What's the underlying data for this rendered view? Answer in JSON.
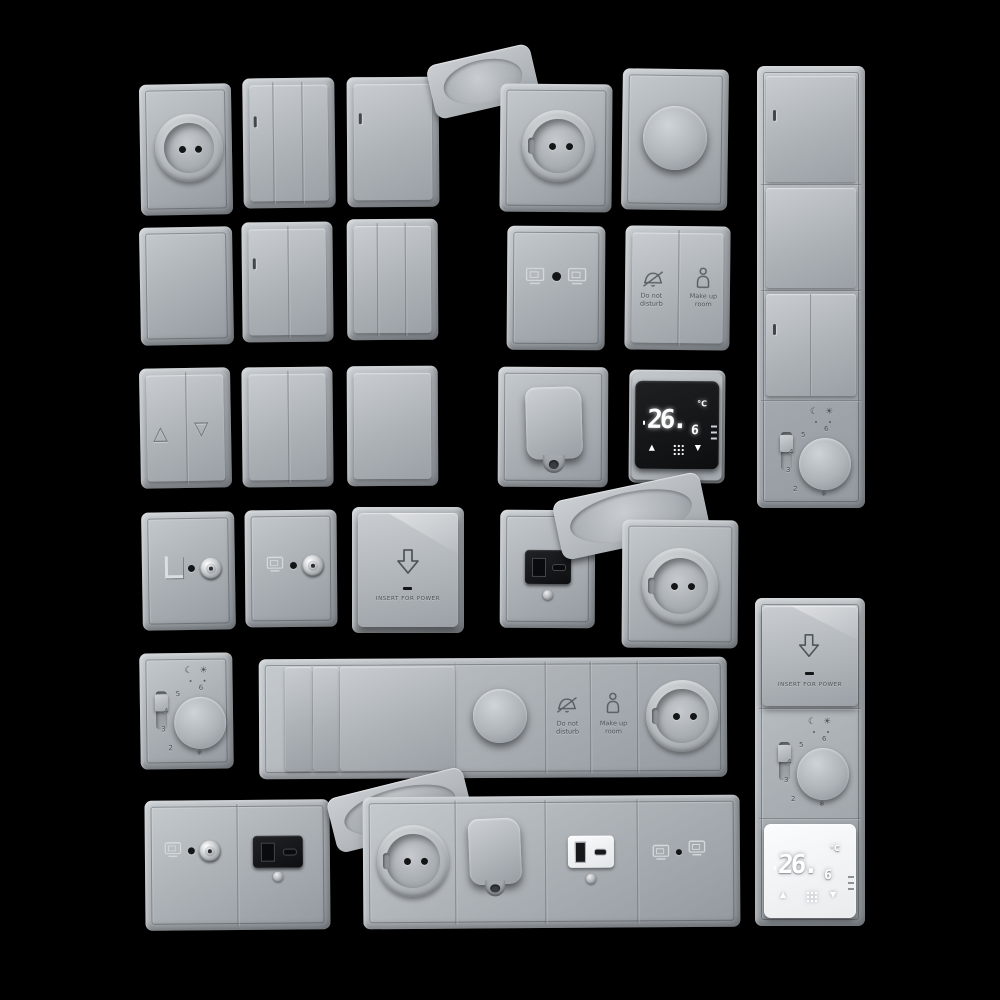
{
  "colors": {
    "background": "#000000",
    "plate": "#aeb3b8",
    "plate_highlight": "#c6cbcf",
    "plate_shadow": "#93999f",
    "display_black": "#141517",
    "display_white": "#f3f4f5",
    "digit_glow": "#ffffff",
    "engraved_text": "#4d5358"
  },
  "labels": {
    "do_not_disturb": {
      "line1": "Do not",
      "line2": "disturb"
    },
    "make_up_room": {
      "line1": "Make up",
      "line2": "room"
    },
    "key_card": {
      "insert_for_power": "INSERT FOR POWER"
    }
  },
  "digital_thermostat": {
    "temp_integer": "26.",
    "temp_decimal": "6",
    "unit": "°C",
    "up_arrow": "▲",
    "down_arrow": "▼"
  },
  "dial_thermostat": {
    "numbers": [
      "2",
      "3",
      "4",
      "5",
      "6"
    ],
    "frost_symbol": "❄",
    "night_symbol": "☾",
    "day_symbol": "☀"
  },
  "shutter_switch": {
    "up_symbol": "△",
    "down_symbol": "▽"
  }
}
